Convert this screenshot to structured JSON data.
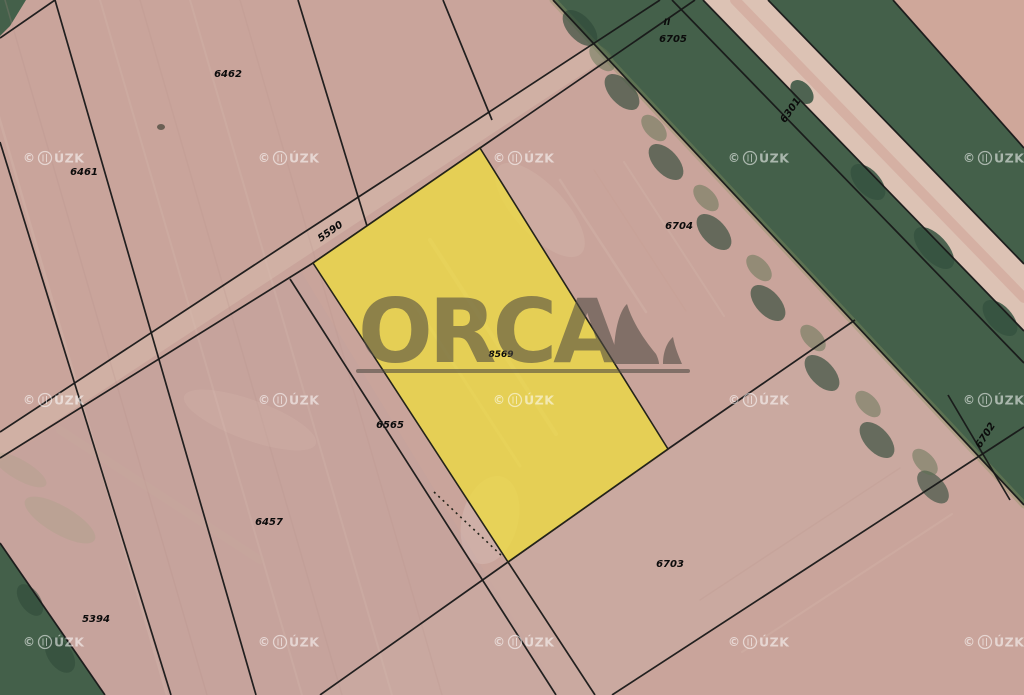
{
  "meta": {
    "app": "cadastral-aerial-map",
    "description": "Aerial cadastral map with highlighted parcel and ORCA watermark",
    "canvas": {
      "width": 1024,
      "height": 695
    }
  },
  "logo": {
    "text": "ORCA",
    "color": "#4e4a42",
    "opacity": 0.58
  },
  "watermark": {
    "prefix": "©",
    "suffix": "ÚZK",
    "full_text": "© ČÚZK",
    "color": "#ffffff",
    "opacity": 0.55,
    "positions": [
      [
        55,
        158
      ],
      [
        290,
        158
      ],
      [
        525,
        158
      ],
      [
        760,
        158
      ],
      [
        995,
        158
      ],
      [
        55,
        400
      ],
      [
        290,
        400
      ],
      [
        525,
        400
      ],
      [
        760,
        400
      ],
      [
        995,
        400
      ],
      [
        55,
        642
      ],
      [
        290,
        642
      ],
      [
        525,
        642
      ],
      [
        760,
        642
      ],
      [
        995,
        642
      ]
    ]
  },
  "highlight": {
    "parcel_number": "8569",
    "points": "480,148 668,449 508,562 313,263",
    "fill": "#f0df3a",
    "fill_opacity": 0.72,
    "stroke": "#23231a",
    "dotted_edge": "434,492 502,556"
  },
  "labels": [
    {
      "text": "6462",
      "x": 228,
      "y": 77,
      "rot": 0,
      "size": 10
    },
    {
      "text": "6461",
      "x": 84,
      "y": 175,
      "rot": 0,
      "size": 10
    },
    {
      "text": "II",
      "x": 667,
      "y": 25,
      "rot": 0,
      "size": 9
    },
    {
      "text": "6705",
      "x": 673,
      "y": 42,
      "rot": 0,
      "size": 10
    },
    {
      "text": "6301",
      "x": 793,
      "y": 112,
      "rot": -55,
      "size": 10
    },
    {
      "text": "6704",
      "x": 679,
      "y": 229,
      "rot": 0,
      "size": 10
    },
    {
      "text": "5590",
      "x": 332,
      "y": 234,
      "rot": -35,
      "size": 10
    },
    {
      "text": "8569",
      "x": 501,
      "y": 357,
      "rot": 0,
      "size": 9
    },
    {
      "text": "6565",
      "x": 390,
      "y": 428,
      "rot": 0,
      "size": 10
    },
    {
      "text": "6457",
      "x": 269,
      "y": 525,
      "rot": 0,
      "size": 10
    },
    {
      "text": "5394",
      "x": 96,
      "y": 622,
      "rot": 0,
      "size": 10
    },
    {
      "text": "6703",
      "x": 670,
      "y": 567,
      "rot": 0,
      "size": 10
    },
    {
      "text": "6702",
      "x": 988,
      "y": 437,
      "rot": -57,
      "size": 10
    }
  ],
  "map": {
    "line_style": {
      "color": "#181818",
      "width": 1.7,
      "opacity": 0.95
    },
    "regions": [
      {
        "name": "field-base",
        "points": "0,0 1024,0 1024,695 0,695",
        "fill": "#c9a49b",
        "opacity": 1
      },
      {
        "name": "field-bottom-left",
        "points": "0,462 300,270 560,695 0,695",
        "fill": "#c2a29c",
        "opacity": 0.55
      },
      {
        "name": "field-top-right-corner",
        "points": "893,0 1024,0 1024,148",
        "fill": "#cfa79a",
        "opacity": 1
      },
      {
        "name": "path-strip-5590",
        "points": "0,432 660,0 695,0 0,458",
        "fill": "#d6b9ac",
        "opacity": 0.55
      },
      {
        "name": "strip-6703",
        "points": "320,695 855,320 980,457 612,695",
        "fill": "#cdb0a6",
        "opacity": 0.45
      },
      {
        "name": "forest-band",
        "points": "553,0 893,0 1024,148 1024,505",
        "fill": "#44604a",
        "opacity": 1
      },
      {
        "name": "forest-corner-top-left",
        "points": "0,0 26,0 10,26 0,36",
        "fill": "#44604a",
        "opacity": 1
      },
      {
        "name": "forest-wedge-bottom-left",
        "points": "0,543 105,695 0,695",
        "fill": "#44604a",
        "opacity": 1
      },
      {
        "name": "road-6301",
        "points": "703,0 768,0 1024,264 1024,331",
        "fill": "#dcc2b4",
        "opacity": 1
      }
    ],
    "streaks": [
      {
        "x1": -35,
        "y1": 0,
        "x2": 167,
        "y2": 695,
        "c": "#d8bcb0",
        "o": 0.3,
        "w": 2.5
      },
      {
        "x1": 5,
        "y1": 0,
        "x2": 207,
        "y2": 695,
        "c": "#b6918a",
        "o": 0.22,
        "w": 1.5
      },
      {
        "x1": 100,
        "y1": 0,
        "x2": 302,
        "y2": 695,
        "c": "#d8bcb0",
        "o": 0.25,
        "w": 2
      },
      {
        "x1": 140,
        "y1": 0,
        "x2": 342,
        "y2": 695,
        "c": "#b6918a",
        "o": 0.2,
        "w": 1.5
      },
      {
        "x1": 190,
        "y1": 0,
        "x2": 392,
        "y2": 695,
        "c": "#d8bcb0",
        "o": 0.25,
        "w": 2
      },
      {
        "x1": 240,
        "y1": 0,
        "x2": 442,
        "y2": 695,
        "c": "#b6918a",
        "o": 0.18,
        "w": 1.5
      },
      {
        "x1": 560,
        "y1": 180,
        "x2": 646,
        "y2": 312,
        "c": "#d8bcb0",
        "o": 0.3,
        "w": 2.5
      },
      {
        "x1": 594,
        "y1": 170,
        "x2": 686,
        "y2": 311,
        "c": "#c79d92",
        "o": 0.25,
        "w": 1.5
      },
      {
        "x1": 624,
        "y1": 162,
        "x2": 724,
        "y2": 316,
        "c": "#d8bcb0",
        "o": 0.25,
        "w": 2
      },
      {
        "x1": 700,
        "y1": 600,
        "x2": 900,
        "y2": 468,
        "c": "#bd988e",
        "o": 0.25,
        "w": 1.5
      },
      {
        "x1": 742,
        "y1": 652,
        "x2": 952,
        "y2": 514,
        "c": "#d8bcb0",
        "o": 0.28,
        "w": 2
      },
      {
        "x1": 430,
        "y1": 240,
        "x2": 556,
        "y2": 434,
        "c": "#ffffff",
        "o": 0.14,
        "w": 4
      },
      {
        "x1": 412,
        "y1": 300,
        "x2": 520,
        "y2": 466,
        "c": "#ffffff",
        "o": 0.12,
        "w": 3
      },
      {
        "x1": 60,
        "y1": 430,
        "x2": 260,
        "y2": 560,
        "c": "#c9ab9f",
        "o": 0.3,
        "w": 8
      },
      {
        "x1": 553,
        "y1": 0,
        "x2": 1024,
        "y2": 505,
        "c": "#8a9360",
        "o": 0.35,
        "w": 7
      },
      {
        "x1": 735,
        "y1": 0,
        "x2": 1024,
        "y2": 298,
        "c": "#cf9f94",
        "o": 0.5,
        "w": 10
      }
    ],
    "blobs": [
      {
        "cx": 580,
        "cy": 28,
        "rx": 22,
        "ry": 12,
        "rot": 47,
        "c": "#2f4939",
        "o": 0.65
      },
      {
        "cx": 622,
        "cy": 92,
        "rx": 22,
        "ry": 12,
        "rot": 47,
        "c": "#2f4939",
        "o": 0.65
      },
      {
        "cx": 666,
        "cy": 162,
        "rx": 22,
        "ry": 12,
        "rot": 47,
        "c": "#2f4939",
        "o": 0.65
      },
      {
        "cx": 714,
        "cy": 232,
        "rx": 22,
        "ry": 12,
        "rot": 47,
        "c": "#2f4939",
        "o": 0.65
      },
      {
        "cx": 768,
        "cy": 303,
        "rx": 22,
        "ry": 12,
        "rot": 47,
        "c": "#2f4939",
        "o": 0.65
      },
      {
        "cx": 822,
        "cy": 373,
        "rx": 22,
        "ry": 12,
        "rot": 47,
        "c": "#2f4939",
        "o": 0.65
      },
      {
        "cx": 877,
        "cy": 440,
        "rx": 22,
        "ry": 12,
        "rot": 47,
        "c": "#2f4939",
        "o": 0.65
      },
      {
        "cx": 933,
        "cy": 487,
        "rx": 20,
        "ry": 11,
        "rot": 47,
        "c": "#2f4939",
        "o": 0.6
      },
      {
        "cx": 602,
        "cy": 58,
        "rx": 16,
        "ry": 9,
        "rot": 47,
        "c": "#5d7251",
        "o": 0.5
      },
      {
        "cx": 654,
        "cy": 128,
        "rx": 16,
        "ry": 9,
        "rot": 47,
        "c": "#5d7251",
        "o": 0.5
      },
      {
        "cx": 706,
        "cy": 198,
        "rx": 16,
        "ry": 9,
        "rot": 47,
        "c": "#5d7251",
        "o": 0.5
      },
      {
        "cx": 759,
        "cy": 268,
        "rx": 16,
        "ry": 9,
        "rot": 47,
        "c": "#5d7251",
        "o": 0.5
      },
      {
        "cx": 813,
        "cy": 338,
        "rx": 16,
        "ry": 9,
        "rot": 47,
        "c": "#5d7251",
        "o": 0.5
      },
      {
        "cx": 868,
        "cy": 404,
        "rx": 16,
        "ry": 9,
        "rot": 47,
        "c": "#5d7251",
        "o": 0.5
      },
      {
        "cx": 925,
        "cy": 462,
        "rx": 16,
        "ry": 9,
        "rot": 47,
        "c": "#5d7251",
        "o": 0.5
      },
      {
        "cx": 802,
        "cy": 92,
        "rx": 14,
        "ry": 9,
        "rot": 47,
        "c": "#35523f",
        "o": 0.85
      },
      {
        "cx": 868,
        "cy": 182,
        "rx": 22,
        "ry": 12,
        "rot": 47,
        "c": "#35523f",
        "o": 0.85
      },
      {
        "cx": 934,
        "cy": 248,
        "rx": 26,
        "ry": 13,
        "rot": 47,
        "c": "#35523f",
        "o": 0.85
      },
      {
        "cx": 1000,
        "cy": 318,
        "rx": 22,
        "ry": 12,
        "rot": 47,
        "c": "#35523f",
        "o": 0.85
      },
      {
        "cx": 30,
        "cy": 600,
        "rx": 18,
        "ry": 10,
        "rot": 55,
        "c": "#2f4939",
        "o": 0.55
      },
      {
        "cx": 60,
        "cy": 655,
        "rx": 20,
        "ry": 12,
        "rot": 55,
        "c": "#2f4939",
        "o": 0.55
      },
      {
        "cx": 60,
        "cy": 520,
        "rx": 40,
        "ry": 14,
        "rot": 30,
        "c": "#9aa07b",
        "o": 0.25
      },
      {
        "cx": 20,
        "cy": 470,
        "rx": 30,
        "ry": 10,
        "rot": 30,
        "c": "#9aa07b",
        "o": 0.2
      },
      {
        "cx": 161,
        "cy": 127,
        "rx": 4,
        "ry": 3,
        "rot": 0,
        "c": "#5f584d",
        "o": 0.9
      },
      {
        "cx": 490,
        "cy": 520,
        "rx": 28,
        "ry": 45,
        "rot": 15,
        "c": "#ffffff",
        "o": 0.12
      },
      {
        "cx": 540,
        "cy": 210,
        "rx": 60,
        "ry": 25,
        "rot": 47,
        "c": "#e2c8ba",
        "o": 0.2
      },
      {
        "cx": 250,
        "cy": 420,
        "rx": 70,
        "ry": 20,
        "rot": 20,
        "c": "#e2c8ba",
        "o": 0.15
      }
    ],
    "boundaries": [
      "55,0 256,695",
      "298,0 367,226",
      "0,142 171,695",
      "443,0 492,120",
      "0,38 55,0",
      "0,458 313,263 480,148 695,0",
      "0,432 300,235 480,118 660,0",
      "290,279 556,695",
      "508,562 595,695",
      "320,695 508,562 668,449 855,320",
      "612,695 1024,427",
      "0,543 105,695",
      "553,0 1024,505",
      "893,0 1024,148",
      "703,0 1024,331",
      "768,0 1024,264",
      "672,0 1024,363",
      "948,395 1010,500"
    ]
  }
}
